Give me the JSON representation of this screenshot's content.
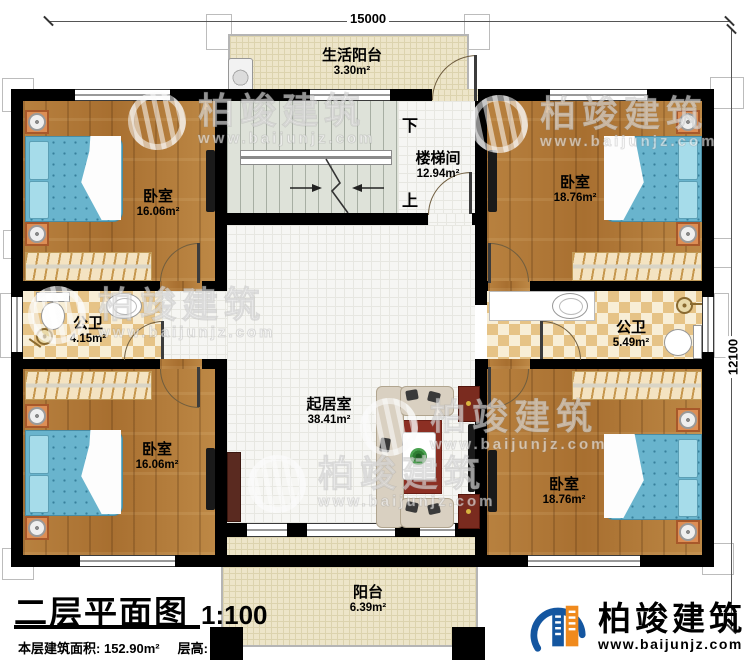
{
  "dim": {
    "top": "15000",
    "right": "12100"
  },
  "rooms": {
    "life_balcony": {
      "name": "生活阳台",
      "area": "3.30m²"
    },
    "stairwell": {
      "name": "楼梯间",
      "area": "12.94m²",
      "down": "下",
      "up": "上"
    },
    "bedroom_tl": {
      "name": "卧室",
      "area": "16.06m²"
    },
    "bedroom_tr": {
      "name": "卧室",
      "area": "18.76m²"
    },
    "bath_left": {
      "name": "公卫",
      "area": "4.15m²"
    },
    "bath_right": {
      "name": "公卫",
      "area": "5.49m²"
    },
    "living": {
      "name": "起居室",
      "area": "38.41m²"
    },
    "bedroom_bl": {
      "name": "卧室",
      "area": "16.06m²"
    },
    "bedroom_br": {
      "name": "卧室",
      "area": "18.76m²"
    },
    "balcony": {
      "name": "阳台",
      "area": "6.39m²"
    }
  },
  "title_block": {
    "title": "二层平面图",
    "scale": "1:100",
    "area_label": "本层建筑面积:",
    "area_value": "152.90m²",
    "floor_height_label": "层高:",
    "floor_height_value": "3.3m"
  },
  "brand": {
    "name": "柏竣建筑",
    "url": "www.baijunjz.com"
  },
  "watermark": {
    "name": "柏竣建筑",
    "url": "www.baijunjz.com"
  },
  "colors": {
    "wall": "#000000",
    "wood": "#b2793a",
    "tile": "#f6f6f3",
    "balcony_floor": "#ede5c9",
    "checker": "#e6c386",
    "stair": "#dee2d9",
    "brand_blue": "#1456a0",
    "brand_orange": "#f08a1d"
  }
}
